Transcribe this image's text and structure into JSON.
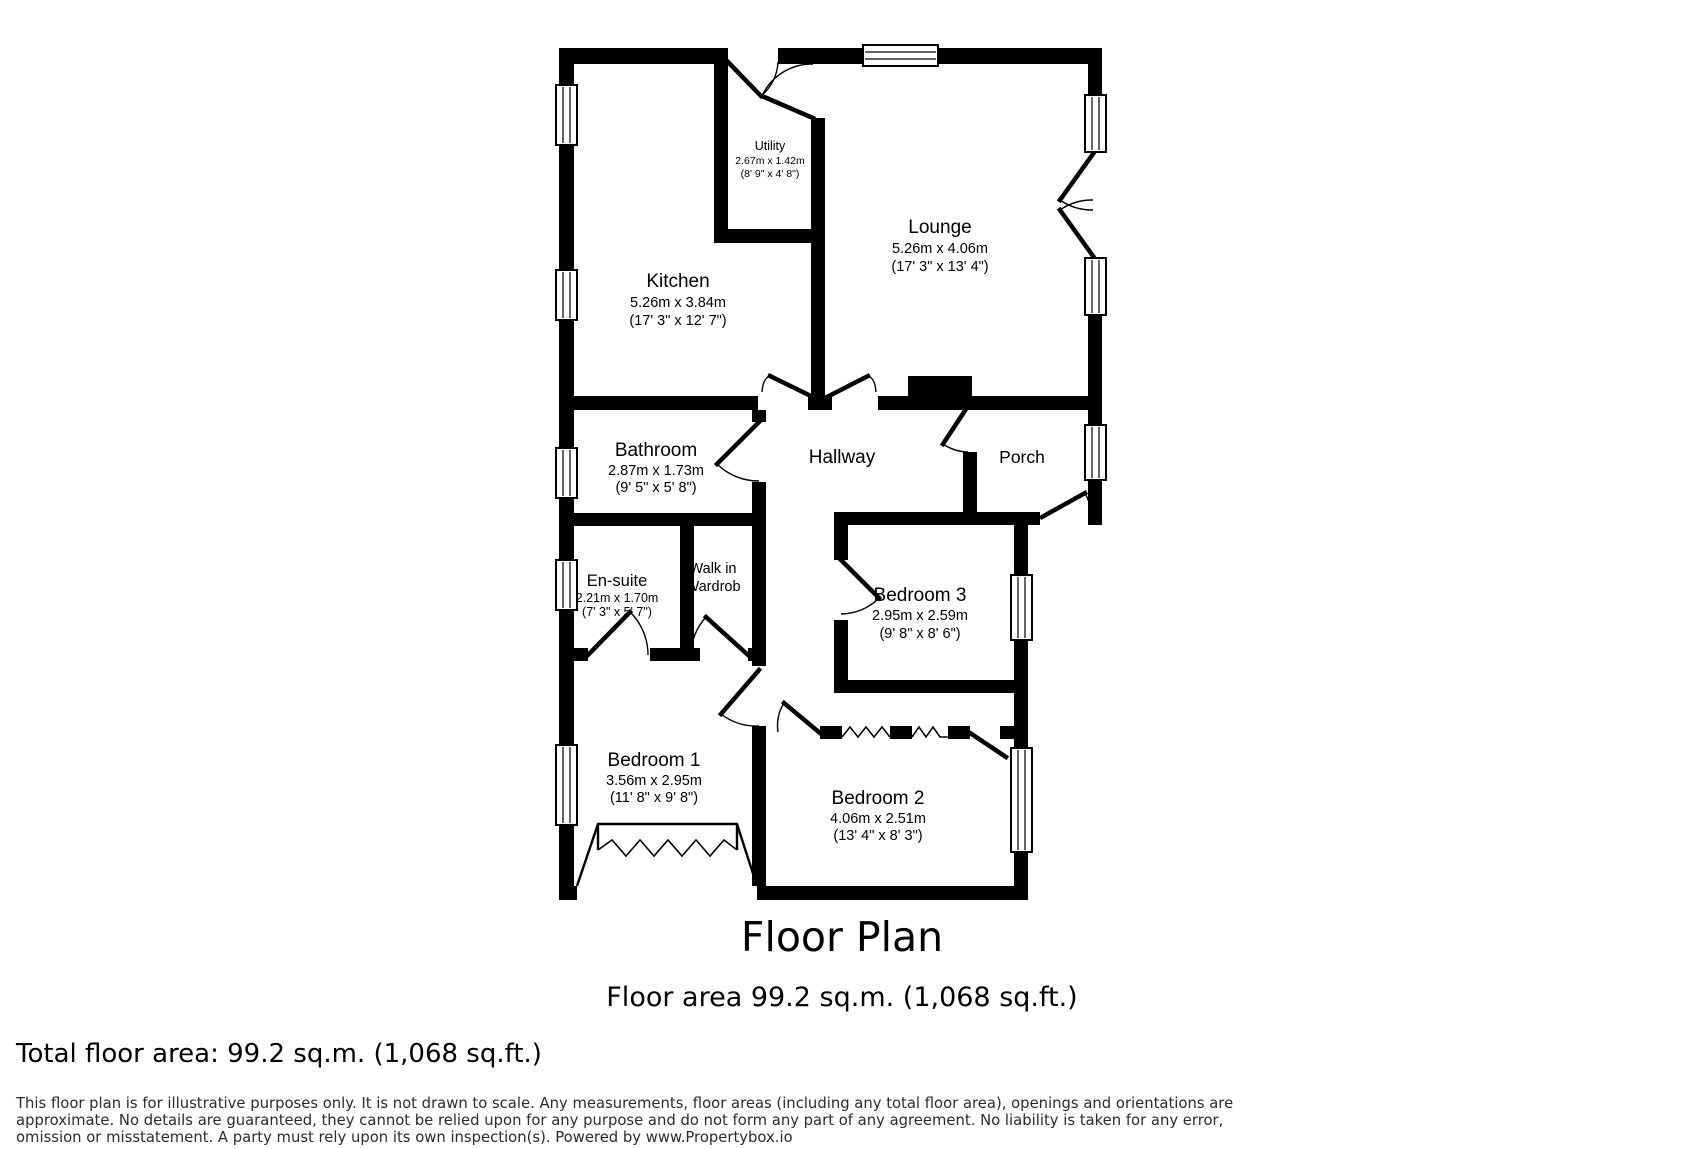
{
  "colors": {
    "wall": "#000000",
    "background": "#ffffff",
    "text": "#000000",
    "disclaimer_text": "#2b2b2b"
  },
  "plan": {
    "rooms": [
      {
        "name": "Utility",
        "metric": "2.67m x 1.42m",
        "imperial": "(8' 9\" x 4' 8\")"
      },
      {
        "name": "Lounge",
        "metric": "5.26m x 4.06m",
        "imperial": "(17' 3\" x 13' 4\")"
      },
      {
        "name": "Kitchen",
        "metric": "5.26m x 3.84m",
        "imperial": "(17' 3\" x 12' 7\")"
      },
      {
        "name": "Bathroom",
        "metric": "2.87m x 1.73m",
        "imperial": "(9' 5\" x 5' 8\")"
      },
      {
        "name": "Hallway"
      },
      {
        "name": "Porch"
      },
      {
        "name": "En-suite",
        "metric": "2.21m x 1.70m",
        "imperial": "(7' 3\" x 5' 7\")"
      },
      {
        "name": "Walk in",
        "name_line2": "Wardrob"
      },
      {
        "name": "Bedroom 3",
        "metric": "2.95m x 2.59m",
        "imperial": "(9' 8\" x 8' 6\")"
      },
      {
        "name": "Bedroom 1",
        "metric": "3.56m x 2.95m",
        "imperial": "(11' 8\" x 9' 8\")"
      },
      {
        "name": "Bedroom 2",
        "metric": "4.06m x 2.51m",
        "imperial": "(13' 4\" x 8' 3\")"
      }
    ]
  },
  "title": {
    "main": "Floor Plan",
    "subtitle": "Floor area 99.2 sq.m. (1,068 sq.ft.)"
  },
  "footer": {
    "total_area": "Total floor area: 99.2 sq.m. (1,068 sq.ft.)",
    "disclaimer_lines": [
      "This floor plan is for illustrative purposes only. It is not drawn to scale. Any measurements, floor areas (including any total floor area), openings and orientations are",
      "approximate. No details are guaranteed, they cannot be relied upon for any purpose and do not form any part of any agreement. No liability is taken for any error,",
      "omission or misstatement. A party must rely upon its own inspection(s). Powered by www.Propertybox.io"
    ]
  }
}
